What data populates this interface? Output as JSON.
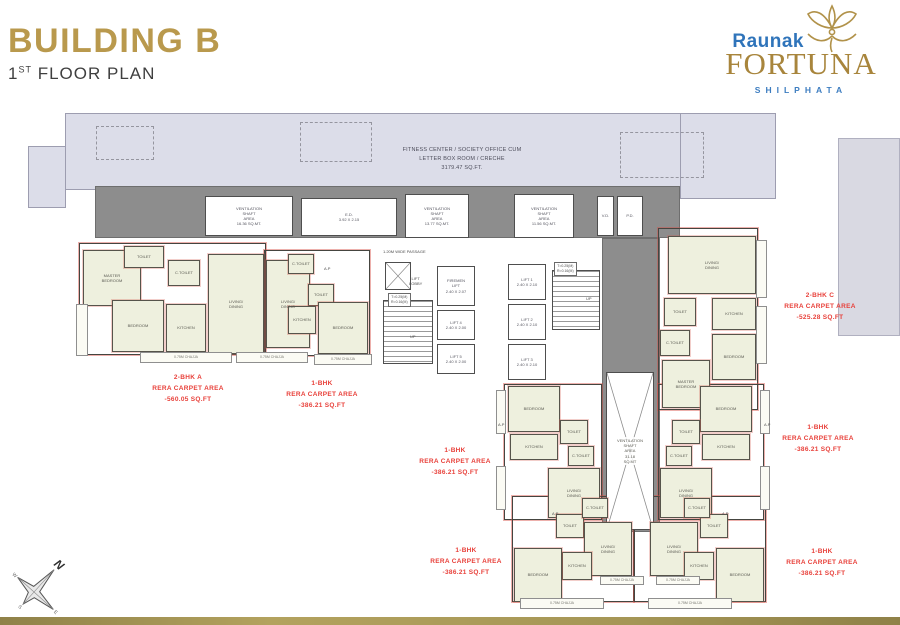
{
  "header": {
    "title": "BUILDING B",
    "floor_num": "1",
    "floor_sup": "ST",
    "floor_rest": " FLOOR PLAN"
  },
  "logo": {
    "brand": "Raunak",
    "name": "FORTUNA",
    "location": "SHILPHATA"
  },
  "compass": {
    "n": "N",
    "e": "E",
    "s": "S",
    "w": "W"
  },
  "colors": {
    "gold": "#b9994d",
    "blue": "#2f74ba",
    "unit_red": "#e8403a",
    "slab": "#dcdde9",
    "corridor_gray": "#8d8d8d",
    "room_cream": "#eef0de"
  },
  "plan": {
    "rooms": [
      {
        "n": "vent-shaft-1",
        "x": 205,
        "y": 196,
        "w": 88,
        "h": 40,
        "l": "VENTILATION\nSHAFT\nAREA\n16.36 SQ.MT.",
        "k": "white"
      },
      {
        "n": "ed-room",
        "x": 301,
        "y": 198,
        "w": 96,
        "h": 38,
        "l": "E.D.\n3.92 X 2.15",
        "k": "white"
      },
      {
        "n": "vent-shaft-2",
        "x": 405,
        "y": 194,
        "w": 64,
        "h": 44,
        "l": "VENTILATION\nSHAFT\nAREA\n13.77 SQ.MT.",
        "k": "white"
      },
      {
        "n": "vent-shaft-3",
        "x": 514,
        "y": 194,
        "w": 60,
        "h": 44,
        "l": "VENTILATION\nSHAFT\nAREA\n11.56 SQ.MT.",
        "k": "white"
      },
      {
        "n": "vd-room",
        "x": 597,
        "y": 196,
        "w": 17,
        "h": 40,
        "l": "V.D.",
        "k": "white"
      },
      {
        "n": "pd-room",
        "x": 617,
        "y": 196,
        "w": 26,
        "h": 40,
        "l": "P.D.",
        "k": "white"
      },
      {
        "n": "duct-shaft",
        "x": 385,
        "y": 262,
        "w": 26,
        "h": 28,
        "k": "cross"
      },
      {
        "n": "firemen-lift",
        "x": 437,
        "y": 266,
        "w": 38,
        "h": 40,
        "l": "FIREMEN\nLIFT\n2.40 X 2.07",
        "k": "white"
      },
      {
        "n": "lift-4",
        "x": 437,
        "y": 310,
        "w": 38,
        "h": 30,
        "l": "LIFT 4\n2.40 X 2.00",
        "k": "white"
      },
      {
        "n": "lift-5",
        "x": 437,
        "y": 344,
        "w": 38,
        "h": 30,
        "l": "LIFT 5\n2.40 X 2.00",
        "k": "white"
      },
      {
        "n": "lift-1",
        "x": 508,
        "y": 264,
        "w": 38,
        "h": 36,
        "l": "LIFT 1\n2.40 X 2.10",
        "k": "white"
      },
      {
        "n": "lift-2",
        "x": 508,
        "y": 304,
        "w": 38,
        "h": 36,
        "l": "LIFT 2\n2.40 X 2.10",
        "k": "white"
      },
      {
        "n": "lift-3",
        "x": 508,
        "y": 344,
        "w": 38,
        "h": 36,
        "l": "LIFT 3\n2.40 X 2.10",
        "k": "white"
      },
      {
        "n": "staircase-west",
        "x": 383,
        "y": 300,
        "w": 50,
        "h": 64,
        "k": "hatch"
      },
      {
        "n": "staircase-east",
        "x": 552,
        "y": 270,
        "w": 48,
        "h": 60,
        "k": "hatch"
      },
      {
        "n": "central-vent-shaft",
        "x": 606,
        "y": 372,
        "w": 48,
        "h": 158,
        "l": "VENTILATION\nSHAFT\nAREA\n31.18\nSQ.MT",
        "k": "cross"
      },
      {
        "n": "room-master-bedroom-a",
        "x": 83,
        "y": 250,
        "w": 58,
        "h": 56,
        "l": "MASTER\nBEDROOM",
        "k": "cream"
      },
      {
        "n": "room-toilet-a",
        "x": 124,
        "y": 246,
        "w": 40,
        "h": 22,
        "l": "TOILET",
        "k": "cream"
      },
      {
        "n": "room-living-a",
        "x": 208,
        "y": 254,
        "w": 56,
        "h": 100,
        "l": "LIVING/\nDINING",
        "k": "cream"
      },
      {
        "n": "room-ctoilet-a",
        "x": 168,
        "y": 260,
        "w": 32,
        "h": 26,
        "l": "C.TOILET",
        "k": "cream"
      },
      {
        "n": "room-bedroom-a",
        "x": 112,
        "y": 300,
        "w": 52,
        "h": 52,
        "l": "BEDROOM",
        "k": "cream"
      },
      {
        "n": "room-kitchen-a",
        "x": 166,
        "y": 304,
        "w": 40,
        "h": 48,
        "l": "KITCHEN",
        "k": "cream"
      },
      {
        "n": "room-living-b1w",
        "x": 266,
        "y": 260,
        "w": 44,
        "h": 88,
        "l": "LIVING/\nDINING",
        "k": "cream"
      },
      {
        "n": "room-ctoilet-b1w",
        "x": 288,
        "y": 254,
        "w": 26,
        "h": 20,
        "l": "C.TOILET",
        "k": "cream"
      },
      {
        "n": "room-toilet-b1w",
        "x": 308,
        "y": 284,
        "w": 26,
        "h": 22,
        "l": "TOILET",
        "k": "cream"
      },
      {
        "n": "room-kitchen-b1w",
        "x": 288,
        "y": 306,
        "w": 28,
        "h": 28,
        "l": "KITCHEN",
        "k": "cream"
      },
      {
        "n": "room-bedroom-b1w",
        "x": 318,
        "y": 302,
        "w": 50,
        "h": 52,
        "l": "BEDROOM",
        "k": "cream"
      },
      {
        "n": "room-living-c",
        "x": 668,
        "y": 236,
        "w": 88,
        "h": 58,
        "l": "LIVING/\nDINING",
        "k": "cream"
      },
      {
        "n": "room-toilet-c",
        "x": 664,
        "y": 298,
        "w": 32,
        "h": 28,
        "l": "TOILET",
        "k": "cream"
      },
      {
        "n": "room-kitchen-c",
        "x": 712,
        "y": 298,
        "w": 44,
        "h": 32,
        "l": "KITCHEN",
        "k": "cream"
      },
      {
        "n": "room-ctoilet-c",
        "x": 660,
        "y": 330,
        "w": 30,
        "h": 26,
        "l": "C.TOILET",
        "k": "cream"
      },
      {
        "n": "room-bedroom-c",
        "x": 712,
        "y": 334,
        "w": 44,
        "h": 46,
        "l": "BEDROOM",
        "k": "cream"
      },
      {
        "n": "room-master-bedroom-c",
        "x": 662,
        "y": 360,
        "w": 48,
        "h": 48,
        "l": "MASTER\nBEDROOM",
        "k": "cream"
      },
      {
        "n": "room-bedroom-midw",
        "x": 508,
        "y": 386,
        "w": 52,
        "h": 46,
        "l": "BEDROOM",
        "k": "cream"
      },
      {
        "n": "room-kitchen-midw",
        "x": 510,
        "y": 434,
        "w": 48,
        "h": 26,
        "l": "KITCHEN",
        "k": "cream"
      },
      {
        "n": "room-toilet-midw",
        "x": 560,
        "y": 420,
        "w": 28,
        "h": 24,
        "l": "TOILET",
        "k": "cream"
      },
      {
        "n": "room-ctoilet-midw",
        "x": 568,
        "y": 446,
        "w": 26,
        "h": 20,
        "l": "C.TOILET",
        "k": "cream"
      },
      {
        "n": "room-living-midw",
        "x": 548,
        "y": 468,
        "w": 52,
        "h": 50,
        "l": "LIVING/\nDINING",
        "k": "cream"
      },
      {
        "n": "room-bedroom-mide",
        "x": 700,
        "y": 386,
        "w": 52,
        "h": 46,
        "l": "BEDROOM",
        "k": "cream"
      },
      {
        "n": "room-kitchen-mide",
        "x": 702,
        "y": 434,
        "w": 48,
        "h": 26,
        "l": "KITCHEN",
        "k": "cream"
      },
      {
        "n": "room-toilet-mide",
        "x": 672,
        "y": 420,
        "w": 28,
        "h": 24,
        "l": "TOILET",
        "k": "cream"
      },
      {
        "n": "room-ctoilet-mide",
        "x": 666,
        "y": 446,
        "w": 26,
        "h": 20,
        "l": "C.TOILET",
        "k": "cream"
      },
      {
        "n": "room-living-mide",
        "x": 660,
        "y": 468,
        "w": 52,
        "h": 50,
        "l": "LIVING/\nDINING",
        "k": "cream"
      },
      {
        "n": "room-toilet-botw",
        "x": 556,
        "y": 514,
        "w": 28,
        "h": 24,
        "l": "TOILET",
        "k": "cream"
      },
      {
        "n": "room-ctoilet-botw",
        "x": 582,
        "y": 498,
        "w": 26,
        "h": 20,
        "l": "C.TOILET",
        "k": "cream"
      },
      {
        "n": "room-living-botw",
        "x": 584,
        "y": 522,
        "w": 48,
        "h": 54,
        "l": "LIVING/\nDINING",
        "k": "cream"
      },
      {
        "n": "room-kitchen-botw",
        "x": 562,
        "y": 552,
        "w": 30,
        "h": 28,
        "l": "KITCHEN",
        "k": "cream"
      },
      {
        "n": "room-bedroom-botw",
        "x": 514,
        "y": 548,
        "w": 48,
        "h": 54,
        "l": "BEDROOM",
        "k": "cream"
      },
      {
        "n": "room-toilet-bote",
        "x": 700,
        "y": 514,
        "w": 28,
        "h": 24,
        "l": "TOILET",
        "k": "cream"
      },
      {
        "n": "room-ctoilet-bote",
        "x": 684,
        "y": 498,
        "w": 26,
        "h": 20,
        "l": "C.TOILET",
        "k": "cream"
      },
      {
        "n": "room-living-bote",
        "x": 650,
        "y": 522,
        "w": 48,
        "h": 54,
        "l": "LIVING/\nDINING",
        "k": "cream"
      },
      {
        "n": "room-kitchen-bote",
        "x": 684,
        "y": 552,
        "w": 30,
        "h": 28,
        "l": "KITCHEN",
        "k": "cream"
      },
      {
        "n": "room-bedroom-bote",
        "x": 716,
        "y": 548,
        "w": 48,
        "h": 54,
        "l": "BEDROOM",
        "k": "cream"
      },
      {
        "n": "chajja-strip",
        "x": 76,
        "y": 304,
        "w": 12,
        "h": 52,
        "k": "chajja"
      },
      {
        "n": "chajja-strip",
        "x": 140,
        "y": 352,
        "w": 92,
        "h": 11,
        "l": "0.75M CHAJJA",
        "k": "chajja"
      },
      {
        "n": "chajja-strip",
        "x": 236,
        "y": 352,
        "w": 72,
        "h": 11,
        "l": "0.75M CHAJJA",
        "k": "chajja"
      },
      {
        "n": "chajja-strip",
        "x": 314,
        "y": 354,
        "w": 58,
        "h": 11,
        "l": "0.75M CHAJJA",
        "k": "chajja"
      },
      {
        "n": "chajja-strip",
        "x": 756,
        "y": 240,
        "w": 11,
        "h": 58,
        "k": "chajja"
      },
      {
        "n": "chajja-strip",
        "x": 756,
        "y": 306,
        "w": 11,
        "h": 58,
        "k": "chajja"
      },
      {
        "n": "chajja-strip",
        "x": 496,
        "y": 390,
        "w": 10,
        "h": 44,
        "k": "chajja"
      },
      {
        "n": "chajja-strip",
        "x": 760,
        "y": 390,
        "w": 10,
        "h": 44,
        "k": "chajja"
      },
      {
        "n": "chajja-strip",
        "x": 496,
        "y": 466,
        "w": 10,
        "h": 44,
        "k": "chajja"
      },
      {
        "n": "chajja-strip",
        "x": 760,
        "y": 466,
        "w": 10,
        "h": 44,
        "k": "chajja"
      },
      {
        "n": "chajja-strip",
        "x": 600,
        "y": 576,
        "w": 44,
        "h": 9,
        "l": "0.75M CHAJJA",
        "k": "chajja"
      },
      {
        "n": "chajja-strip",
        "x": 656,
        "y": 576,
        "w": 44,
        "h": 9,
        "l": "0.75M CHAJJA",
        "k": "chajja"
      },
      {
        "n": "chajja-strip",
        "x": 520,
        "y": 598,
        "w": 84,
        "h": 11,
        "l": "0.75M CHAJJA",
        "k": "chajja"
      },
      {
        "n": "chajja-strip",
        "x": 648,
        "y": 598,
        "w": 84,
        "h": 11,
        "l": "0.75M CHAJJA",
        "k": "chajja"
      }
    ],
    "outlines": [
      {
        "n": "unit-outline-2bhk-a",
        "x": 79,
        "y": 243,
        "w": 187,
        "h": 112
      },
      {
        "n": "unit-outline-1bhk-west",
        "x": 264,
        "y": 250,
        "w": 106,
        "h": 106
      },
      {
        "n": "unit-outline-2bhk-c",
        "x": 658,
        "y": 228,
        "w": 100,
        "h": 182
      },
      {
        "n": "unit-outline-1bhk-midw",
        "x": 504,
        "y": 384,
        "w": 98,
        "h": 136
      },
      {
        "n": "unit-outline-1bhk-mide",
        "x": 658,
        "y": 384,
        "w": 106,
        "h": 136
      },
      {
        "n": "unit-outline-1bhk-botw",
        "x": 512,
        "y": 496,
        "w": 122,
        "h": 106
      },
      {
        "n": "unit-outline-1bhk-bote",
        "x": 634,
        "y": 496,
        "w": 132,
        "h": 106
      }
    ],
    "labels": [
      {
        "n": "fitness-area-label",
        "cx": 462,
        "y": 146,
        "k": "fitness",
        "lines": [
          "FITNESS CENTER / SOCIETY OFFICE CUM",
          "LETTER BOX ROOM / CRECHE",
          "3179.47 SQ.FT."
        ]
      },
      {
        "n": "unit-label-2bhk-a",
        "cx": 188,
        "y": 372,
        "k": "unit",
        "lines": [
          "2-BHK A",
          "RERA CARPET AREA",
          "-560.05 SQ.FT"
        ]
      },
      {
        "n": "unit-label-1bhk-west",
        "cx": 322,
        "y": 378,
        "k": "unit",
        "lines": [
          "1-BHK",
          "RERA CARPET AREA",
          "-386.21 SQ.FT"
        ]
      },
      {
        "n": "unit-label-2bhk-c",
        "cx": 820,
        "y": 290,
        "k": "unit",
        "lines": [
          "2-BHK C",
          "RERA CARPET AREA",
          "-525.28 SQ.FT"
        ]
      },
      {
        "n": "unit-label-1bhk-center",
        "cx": 455,
        "y": 445,
        "k": "unit",
        "lines": [
          "1-BHK",
          "RERA CARPET AREA",
          "-386.21 SQ.FT"
        ]
      },
      {
        "n": "unit-label-1bhk-east",
        "cx": 818,
        "y": 422,
        "k": "unit",
        "lines": [
          "1-BHK",
          "RERA CARPET AREA",
          "-386.21 SQ.FT"
        ]
      },
      {
        "n": "unit-label-1bhk-bottom-center",
        "cx": 466,
        "y": 545,
        "k": "unit",
        "lines": [
          "1-BHK",
          "RERA CARPET AREA",
          "-386.21 SQ.FT"
        ]
      },
      {
        "n": "unit-label-1bhk-bottom-east",
        "cx": 822,
        "y": 546,
        "k": "unit",
        "lines": [
          "1-BHK",
          "RERA CARPET AREA",
          "-386.21 SQ.FT"
        ]
      },
      {
        "n": "passage-label",
        "x": 383,
        "y": 249,
        "k": "tiny",
        "lines": [
          "1.20M WIDE PASSAGE"
        ]
      },
      {
        "n": "lift-lobby-label",
        "x": 409,
        "y": 276,
        "k": "tiny",
        "lines": [
          "LIFT",
          "LOBBY"
        ]
      },
      {
        "n": "stair-note-west",
        "x": 388,
        "y": 293,
        "k": "boxed",
        "lines": [
          "T=0.25(M)",
          "R=0.16(M)"
        ]
      },
      {
        "n": "stair-note-east",
        "x": 554,
        "y": 262,
        "k": "boxed",
        "lines": [
          "T=0.25(M)",
          "R=0.16(M)"
        ]
      },
      {
        "n": "up-label-west",
        "x": 410,
        "y": 334,
        "k": "tiny",
        "lines": [
          "UP"
        ]
      },
      {
        "n": "up-label-east",
        "x": 586,
        "y": 296,
        "k": "tiny",
        "lines": [
          "UP"
        ]
      },
      {
        "n": "ap-label",
        "x": 324,
        "y": 266,
        "k": "tiny",
        "lines": [
          "A.P"
        ]
      },
      {
        "n": "ap-label",
        "x": 498,
        "y": 422,
        "k": "tiny",
        "lines": [
          "A.P"
        ]
      },
      {
        "n": "ap-label",
        "x": 764,
        "y": 422,
        "k": "tiny",
        "lines": [
          "A.P"
        ]
      },
      {
        "n": "ap-label",
        "x": 552,
        "y": 511,
        "k": "tiny",
        "lines": [
          "A.P"
        ]
      },
      {
        "n": "ap-label",
        "x": 722,
        "y": 511,
        "k": "tiny",
        "lines": [
          "A.P"
        ]
      }
    ]
  }
}
